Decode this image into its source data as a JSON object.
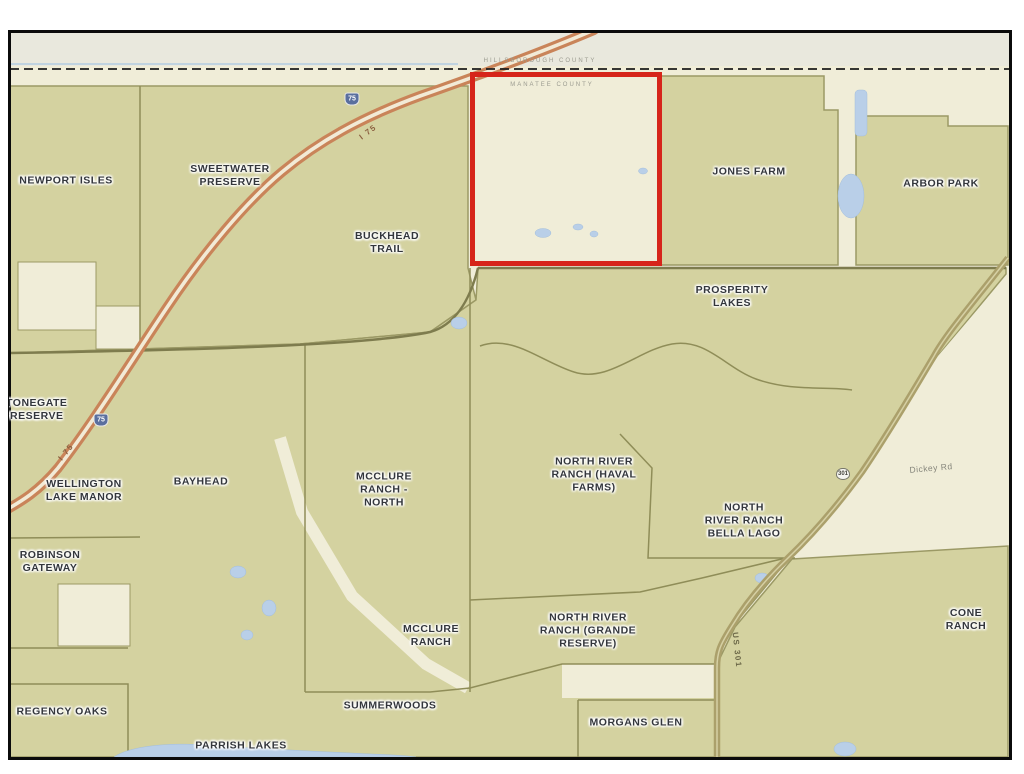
{
  "regions": [
    {
      "name": "newport-isles",
      "label": "NEWPORT ISLES"
    },
    {
      "name": "sweetwater-preserve",
      "label": "SWEETWATER\nPRESERVE"
    },
    {
      "name": "buckhead-trail",
      "label": "BUCKHEAD\nTRAIL"
    },
    {
      "name": "jones-farm",
      "label": "JONES FARM"
    },
    {
      "name": "arbor-park",
      "label": "ARBOR PARK"
    },
    {
      "name": "prosperity-lakes",
      "label": "PROSPERITY\nLAKES"
    },
    {
      "name": "stonegate-preserve",
      "label": "STONEGATE\nPRESERVE"
    },
    {
      "name": "wellington-lake-manor",
      "label": "WELLINGTON\nLAKE MANOR"
    },
    {
      "name": "bayhead",
      "label": "BAYHEAD"
    },
    {
      "name": "mcclure-ranch-north",
      "label": "MCCLURE\nRANCH -\nNORTH"
    },
    {
      "name": "north-river-ranch-haval-farms",
      "label": "NORTH RIVER\nRANCH (HAVAL\nFARMS)"
    },
    {
      "name": "north-river-ranch-bella-lago",
      "label": "NORTH\nRIVER RANCH\nBELLA LAGO"
    },
    {
      "name": "robinson-gateway",
      "label": "ROBINSON\nGATEWAY"
    },
    {
      "name": "mcclure-ranch",
      "label": "MCCLURE\nRANCH"
    },
    {
      "name": "north-river-ranch-grande-reserve",
      "label": "NORTH RIVER\nRANCH (GRANDE\nRESERVE)"
    },
    {
      "name": "cone-ranch",
      "label": "CONE RANCH"
    },
    {
      "name": "regency-oaks",
      "label": "REGENCY OAKS"
    },
    {
      "name": "summerwoods",
      "label": "SUMMERWOODS"
    },
    {
      "name": "morgans-glen",
      "label": "MORGANS GLEN"
    },
    {
      "name": "parrish-lakes",
      "label": "PARRISH LAKES"
    }
  ],
  "roads": {
    "interstate_label": "I 75",
    "interstate_shield": "75",
    "us_route_shield": "301",
    "us_route_label": "US 301",
    "minor_road_label": "Dickey Rd"
  },
  "county_line": {
    "top_label": "HILLSBOROUGH COUNTY",
    "bottom_label": "MANATEE COUNTY"
  },
  "highlight": {
    "color": "#d6251a"
  },
  "palette": {
    "parcel_olive": "#d4d2a0",
    "background_cream": "#f0edd8",
    "above_line_band": "#e9e8dd",
    "boundary": "#8f8d58",
    "interstate_road": "#c98459",
    "us_route_road": "#aba06b",
    "water": "#b9cfe8",
    "frame": "#0b0b0b"
  }
}
